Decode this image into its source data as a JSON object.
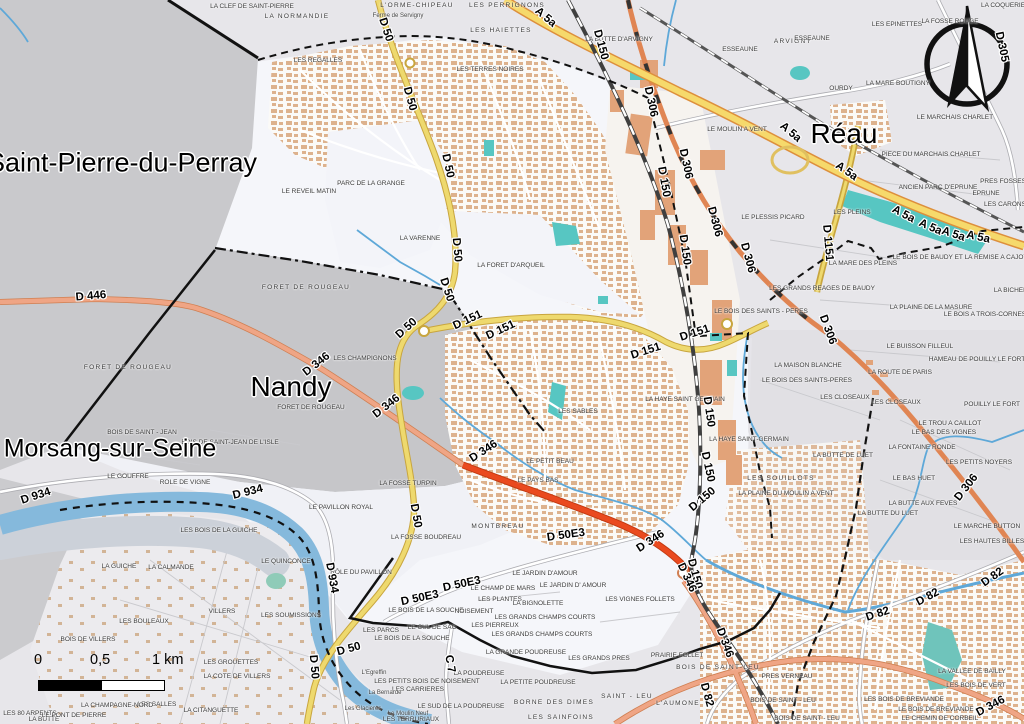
{
  "map": {
    "colors": {
      "water": "#85b9dc",
      "pond": "#57c6c2",
      "motorway": "#f6d96b",
      "motorway_casing": "#dd8f3c",
      "primary_orange": "#e08553",
      "secondary_salmon": "#efa585",
      "trunk_red": "#ea4a1f",
      "tertiary_yellow": "#eed96e",
      "forest_gray": "#c6c6c9",
      "neighbor_gray": "#c9c9cc",
      "commune_white": "#f5f6fa",
      "urban_building": "#ddb28d",
      "boundary": "#111111"
    },
    "towns": [
      {
        "t": "Saint-Pierre-du-Perray",
        "x": 122,
        "y": 163,
        "s": 27
      },
      {
        "t": "Morsang-sur-Seine",
        "x": 110,
        "y": 449,
        "s": 25
      },
      {
        "t": "Nandy",
        "x": 291,
        "y": 387,
        "s": 28
      },
      {
        "t": "Réau",
        "x": 844,
        "y": 134,
        "s": 28
      }
    ],
    "road_shields": [
      {
        "t": "D 50",
        "x": 385,
        "y": 30,
        "r": 72
      },
      {
        "t": "D 50",
        "x": 409,
        "y": 99,
        "r": 75
      },
      {
        "t": "D 50",
        "x": 447,
        "y": 166,
        "r": 78
      },
      {
        "t": "D 50",
        "x": 456,
        "y": 250,
        "r": 85
      },
      {
        "t": "D 50",
        "x": 446,
        "y": 290,
        "r": 72
      },
      {
        "t": "D 50",
        "x": 407,
        "y": 329,
        "r": -42
      },
      {
        "t": "D 50",
        "x": 415,
        "y": 516,
        "r": 80
      },
      {
        "t": "D 50",
        "x": 313,
        "y": 667,
        "r": 85
      },
      {
        "t": "D 50",
        "x": 349,
        "y": 650,
        "r": -15
      },
      {
        "t": "D 151",
        "x": 468,
        "y": 321,
        "r": -25
      },
      {
        "t": "D 151",
        "x": 501,
        "y": 331,
        "r": -25
      },
      {
        "t": "D 151",
        "x": 646,
        "y": 352,
        "r": -18
      },
      {
        "t": "D 151",
        "x": 695,
        "y": 334,
        "r": -18
      },
      {
        "t": "D 150",
        "x": 600,
        "y": 45,
        "r": 75
      },
      {
        "t": "D 150",
        "x": 663,
        "y": 182,
        "r": 80
      },
      {
        "t": "D 150",
        "x": 684,
        "y": 250,
        "r": 82
      },
      {
        "t": "D 150",
        "x": 708,
        "y": 412,
        "r": 82
      },
      {
        "t": "D 150",
        "x": 707,
        "y": 467,
        "r": 78
      },
      {
        "t": "D 150",
        "x": 703,
        "y": 500,
        "r": -40
      },
      {
        "t": "D 150",
        "x": 694,
        "y": 574,
        "r": 75
      },
      {
        "t": "D 306",
        "x": 650,
        "y": 102,
        "r": 78
      },
      {
        "t": "D 306",
        "x": 685,
        "y": 164,
        "r": 78
      },
      {
        "t": "D 306",
        "x": 714,
        "y": 222,
        "r": 75
      },
      {
        "t": "D 306",
        "x": 747,
        "y": 258,
        "r": 75
      },
      {
        "t": "D 306",
        "x": 827,
        "y": 330,
        "r": 70
      },
      {
        "t": "D 306",
        "x": 967,
        "y": 488,
        "r": -52
      },
      {
        "t": "A 5a",
        "x": 545,
        "y": 18,
        "r": 40
      },
      {
        "t": "A 5a",
        "x": 790,
        "y": 133,
        "r": 40
      },
      {
        "t": "A 5a",
        "x": 846,
        "y": 172,
        "r": 35
      },
      {
        "t": "A 5a",
        "x": 903,
        "y": 215,
        "r": 28
      },
      {
        "t": "A 5a",
        "x": 930,
        "y": 228,
        "r": 24
      },
      {
        "t": "A 5a",
        "x": 953,
        "y": 235,
        "r": 18
      },
      {
        "t": "A 5a",
        "x": 978,
        "y": 238,
        "r": 12
      },
      {
        "t": "D 446",
        "x": 91,
        "y": 297,
        "r": -5
      },
      {
        "t": "D 934",
        "x": 36,
        "y": 497,
        "r": -18
      },
      {
        "t": "D 934",
        "x": 248,
        "y": 493,
        "r": -14
      },
      {
        "t": "D 934",
        "x": 331,
        "y": 578,
        "r": 80
      },
      {
        "t": "D 82",
        "x": 993,
        "y": 578,
        "r": -35
      },
      {
        "t": "D 82",
        "x": 928,
        "y": 598,
        "r": -28
      },
      {
        "t": "D 82",
        "x": 878,
        "y": 615,
        "r": -18
      },
      {
        "t": "D 82",
        "x": 706,
        "y": 695,
        "r": 75
      },
      {
        "t": "D 346",
        "x": 317,
        "y": 365,
        "r": -38
      },
      {
        "t": "D 346",
        "x": 387,
        "y": 407,
        "r": -38
      },
      {
        "t": "D 346",
        "x": 484,
        "y": 452,
        "r": -33
      },
      {
        "t": "D 346",
        "x": 651,
        "y": 542,
        "r": -33
      },
      {
        "t": "D 346",
        "x": 686,
        "y": 578,
        "r": 65
      },
      {
        "t": "D 346",
        "x": 724,
        "y": 643,
        "r": 70
      },
      {
        "t": "D 346",
        "x": 991,
        "y": 707,
        "r": -28
      },
      {
        "t": "D 50E3",
        "x": 566,
        "y": 536,
        "r": -8
      },
      {
        "t": "D 50E3",
        "x": 462,
        "y": 585,
        "r": -12
      },
      {
        "t": "D 50E3",
        "x": 420,
        "y": 599,
        "r": -12
      },
      {
        "t": "C 7",
        "x": 449,
        "y": 664,
        "r": 80
      },
      {
        "t": "D 1151",
        "x": 827,
        "y": 243,
        "r": 85
      },
      {
        "t": "D 305",
        "x": 1001,
        "y": 47,
        "r": 78
      }
    ],
    "places": [
      {
        "t": "LA CLEF DE SAINT-PIERRE",
        "x": 252,
        "y": 7
      },
      {
        "t": "LA NORMANDIE",
        "x": 297,
        "y": 17,
        "sp": 1
      },
      {
        "t": "L'ORME-CHIPEAU",
        "x": 417,
        "y": 6,
        "sp": 1
      },
      {
        "t": "LES PERRIGNONS",
        "x": 507,
        "y": 6,
        "sp": 1
      },
      {
        "t": "Ferme de Servigny",
        "x": 398,
        "y": 16,
        "mc": 1
      },
      {
        "t": "LES HAIETTES",
        "x": 501,
        "y": 31,
        "sp": 1
      },
      {
        "t": "LES REGALLES",
        "x": 318,
        "y": 61
      },
      {
        "t": "LES TERRES NOIRES",
        "x": 490,
        "y": 70
      },
      {
        "t": "LA BUTTE D'ARVIGNY",
        "x": 619,
        "y": 40
      },
      {
        "t": "ARVIGNY",
        "x": 793,
        "y": 42,
        "sp": 1
      },
      {
        "t": "ESSEAUNE",
        "x": 812,
        "y": 39
      },
      {
        "t": "ESSEAUNE",
        "x": 740,
        "y": 50
      },
      {
        "t": "LES EPINETTES",
        "x": 897,
        "y": 25
      },
      {
        "t": "LA FOSSE ROUGE",
        "x": 950,
        "y": 22
      },
      {
        "t": "LA COQUERIE",
        "x": 1003,
        "y": 6
      },
      {
        "t": "OURDY",
        "x": 841,
        "y": 89
      },
      {
        "t": "LA MARE BOUTIGNY",
        "x": 898,
        "y": 84
      },
      {
        "t": "LE MARCHAIS CHARLET",
        "x": 955,
        "y": 118
      },
      {
        "t": "LE MOULIN A VENT",
        "x": 737,
        "y": 130
      },
      {
        "t": "PIECE DU MARCHAIS CHARLET",
        "x": 931,
        "y": 155
      },
      {
        "t": "ANCIEN PARC D'EPRUNE",
        "x": 938,
        "y": 188
      },
      {
        "t": "PRES FOSSES",
        "x": 1003,
        "y": 182
      },
      {
        "t": "EPRUNE",
        "x": 986,
        "y": 194
      },
      {
        "t": "LES CARONS",
        "x": 1005,
        "y": 205
      },
      {
        "t": "LES PLEINS",
        "x": 852,
        "y": 213
      },
      {
        "t": "LE PLESSIS PICARD",
        "x": 773,
        "y": 218
      },
      {
        "t": "LA MARE DES PLEINS",
        "x": 863,
        "y": 264
      },
      {
        "t": "LES GRANDS REAGES DE BAUDY",
        "x": 822,
        "y": 289
      },
      {
        "t": "LE BOIS DE BAUDY ET LA REMISE A CAJOT",
        "x": 960,
        "y": 258
      },
      {
        "t": "LA BICHERE",
        "x": 1013,
        "y": 291
      },
      {
        "t": "LA PLAINE DE LA MASURE",
        "x": 931,
        "y": 308
      },
      {
        "t": "LE BOIS A TROIS-CORNES",
        "x": 985,
        "y": 315
      },
      {
        "t": "LE BUISSON FILLEUL",
        "x": 920,
        "y": 347
      },
      {
        "t": "HAMEAU DE POUILLY LE FORT",
        "x": 977,
        "y": 360
      },
      {
        "t": "LA ROUTE DE PARIS",
        "x": 900,
        "y": 373
      },
      {
        "t": "POUILLY LE FORT",
        "x": 992,
        "y": 405
      },
      {
        "t": "LE TROU A CAILLOT",
        "x": 950,
        "y": 424
      },
      {
        "t": "LE BAS DES VIGNES",
        "x": 944,
        "y": 433
      },
      {
        "t": "LA FONTAINE RONDE",
        "x": 922,
        "y": 448
      },
      {
        "t": "LES PETITS NOYERS",
        "x": 979,
        "y": 463
      },
      {
        "t": "LE BAS HUET",
        "x": 914,
        "y": 479
      },
      {
        "t": "LA BUTTE AUX FEVES",
        "x": 923,
        "y": 504
      },
      {
        "t": "LE MARCHE BUTTON",
        "x": 987,
        "y": 527
      },
      {
        "t": "LES HAUTES BILLES",
        "x": 992,
        "y": 542
      },
      {
        "t": "LA BUTTE DE LUET",
        "x": 843,
        "y": 456
      },
      {
        "t": "LA BUTTE DU LUET",
        "x": 888,
        "y": 514
      },
      {
        "t": "LES SOUILLOTS",
        "x": 781,
        "y": 479,
        "sp": 1
      },
      {
        "t": "LA PLAINE DU MOULIN A VENT",
        "x": 786,
        "y": 494
      },
      {
        "t": "LA HAYE SAINT-GERMAIN",
        "x": 749,
        "y": 440
      },
      {
        "t": "LA HAYE SAINT GERMAIN",
        "x": 685,
        "y": 400
      },
      {
        "t": "LES SABLES",
        "x": 578,
        "y": 412
      },
      {
        "t": "LES CLOSEAUX",
        "x": 845,
        "y": 398
      },
      {
        "t": "LES CLOSEAUX",
        "x": 896,
        "y": 403
      },
      {
        "t": "LA MAISON BLANCHE",
        "x": 808,
        "y": 366
      },
      {
        "t": "LE BOIS DES SAINTS-PERES",
        "x": 807,
        "y": 381
      },
      {
        "t": "LE BOIS DES SAINTS - PERES",
        "x": 761,
        "y": 312
      },
      {
        "t": "PARC DE LA GRANGE",
        "x": 371,
        "y": 184
      },
      {
        "t": "LE REVEIL MATIN",
        "x": 309,
        "y": 192
      },
      {
        "t": "LA VARENNE",
        "x": 420,
        "y": 239
      },
      {
        "t": "LA FORET D'ARQUEIL",
        "x": 511,
        "y": 266
      },
      {
        "t": "FORET DE ROUGEAU",
        "x": 306,
        "y": 288,
        "sp": 1
      },
      {
        "t": "FORET DE ROUGEAU",
        "x": 128,
        "y": 368,
        "sp": 1
      },
      {
        "t": "FORET DE ROUGEAU",
        "x": 311,
        "y": 408
      },
      {
        "t": "LES CHAMPIGNONS",
        "x": 365,
        "y": 359
      },
      {
        "t": "BOIS DE SAINT - JEAN",
        "x": 142,
        "y": 433
      },
      {
        "t": "BOIS DE SAINT-JEAN DE L'ISLE",
        "x": 230,
        "y": 443
      },
      {
        "t": "LE GOUFFRE",
        "x": 128,
        "y": 477
      },
      {
        "t": "ROLE DE VIGNE",
        "x": 185,
        "y": 483
      },
      {
        "t": "LE PAVILLON ROYAL",
        "x": 341,
        "y": 508
      },
      {
        "t": "LES BOIS DE LA GUICHE",
        "x": 219,
        "y": 531
      },
      {
        "t": "LE QUINCONCE",
        "x": 286,
        "y": 562
      },
      {
        "t": "LA GUICHE",
        "x": 119,
        "y": 567
      },
      {
        "t": "LA CALMANDE",
        "x": 171,
        "y": 568
      },
      {
        "t": "VILLERS",
        "x": 222,
        "y": 612
      },
      {
        "t": "LES BOULEAUX",
        "x": 144,
        "y": 622
      },
      {
        "t": "BOIS DE VILLERS",
        "x": 88,
        "y": 640
      },
      {
        "t": "LES SOUMISSIONS",
        "x": 291,
        "y": 616
      },
      {
        "t": "LES GROUETTES",
        "x": 231,
        "y": 663
      },
      {
        "t": "LA COTE DE VILLERS",
        "x": 237,
        "y": 677
      },
      {
        "t": "LES SALLES",
        "x": 157,
        "y": 705
      },
      {
        "t": "LA CHAMPAGNE-NORD",
        "x": 117,
        "y": 706
      },
      {
        "t": "LES 80 ARPENTS",
        "x": 30,
        "y": 714
      },
      {
        "t": "LA BUTTE",
        "x": 44,
        "y": 720
      },
      {
        "t": "LE PONT DE PIERRE",
        "x": 74,
        "y": 716
      },
      {
        "t": "LA CITANGUETTE",
        "x": 211,
        "y": 711
      },
      {
        "t": "LA FOSSE TURPIN",
        "x": 408,
        "y": 484
      },
      {
        "t": "LA FOSSE BOUDREAU",
        "x": 426,
        "y": 538
      },
      {
        "t": "MONTBREAU",
        "x": 498,
        "y": 527,
        "sp": 1
      },
      {
        "t": "LE PETIT BEAU",
        "x": 550,
        "y": 462
      },
      {
        "t": "LE PAYS BAS",
        "x": 538,
        "y": 481
      },
      {
        "t": "RÔLE DU PAVILLON",
        "x": 361,
        "y": 573
      },
      {
        "t": "LES PARCS",
        "x": 381,
        "y": 631
      },
      {
        "t": "LE BOIS DE LA SOUCHE",
        "x": 426,
        "y": 611
      },
      {
        "t": "NOISEMENT",
        "x": 474,
        "y": 612
      },
      {
        "t": "LE CUL DE SAC",
        "x": 432,
        "y": 628
      },
      {
        "t": "LE BOIS DE LA SOUCHE",
        "x": 412,
        "y": 639
      },
      {
        "t": "LES PIERREUX",
        "x": 495,
        "y": 626
      },
      {
        "t": "LE CHAMP DE MARS",
        "x": 503,
        "y": 589
      },
      {
        "t": "LES PLANTES",
        "x": 500,
        "y": 600
      },
      {
        "t": "LA BIGNOLETTE",
        "x": 538,
        "y": 604
      },
      {
        "t": "LE JARDIN D'AMOUR",
        "x": 545,
        "y": 574
      },
      {
        "t": "LE JARDIN D' AMOUR",
        "x": 573,
        "y": 586
      },
      {
        "t": "LES GRANDS CHAMPS COURTS",
        "x": 545,
        "y": 618
      },
      {
        "t": "LES GRANDS CHAMPS COURTS",
        "x": 542,
        "y": 635
      },
      {
        "t": "LES VIGNES FOLLETS",
        "x": 640,
        "y": 600
      },
      {
        "t": "LA GRANDE POUDREUSE",
        "x": 526,
        "y": 653
      },
      {
        "t": "LES GRANDS PRES",
        "x": 599,
        "y": 659
      },
      {
        "t": "PRAIRIE FOLLET",
        "x": 677,
        "y": 656
      },
      {
        "t": "BOIS DE SAINT-LEU",
        "x": 718,
        "y": 668,
        "sp": 1
      },
      {
        "t": "LA POUDREUSE",
        "x": 479,
        "y": 674
      },
      {
        "t": "LES PETITS BOIS DE NOISEMENT",
        "x": 427,
        "y": 682
      },
      {
        "t": "LES CARRIERES",
        "x": 418,
        "y": 690
      },
      {
        "t": "La Bernarde",
        "x": 385,
        "y": 693,
        "mc": 1
      },
      {
        "t": "L'Egreffin",
        "x": 374,
        "y": 673,
        "mc": 1
      },
      {
        "t": "Les Glacieres",
        "x": 363,
        "y": 709,
        "mc": 1
      },
      {
        "t": "Le Moulin Neuf",
        "x": 408,
        "y": 714,
        "mc": 1
      },
      {
        "t": "LES TERRURIAUX",
        "x": 411,
        "y": 720
      },
      {
        "t": "LE SUD DE LA POUDREUSE",
        "x": 461,
        "y": 707
      },
      {
        "t": "LA PETITE POUDREUSE",
        "x": 538,
        "y": 683
      },
      {
        "t": "BORNE DES DIMES",
        "x": 554,
        "y": 703,
        "sp": 1
      },
      {
        "t": "LES SAINFOINS",
        "x": 561,
        "y": 718,
        "sp": 1
      },
      {
        "t": "SAINT - LEU",
        "x": 627,
        "y": 697,
        "sp": 1
      },
      {
        "t": "L'AUMONE",
        "x": 678,
        "y": 704,
        "sp": 1
      },
      {
        "t": "PRES VERNEAU",
        "x": 787,
        "y": 677
      },
      {
        "t": "BOIS DE SAINT - LEU",
        "x": 783,
        "y": 701
      },
      {
        "t": "BOIS DE SAINT - LEU",
        "x": 807,
        "y": 719
      },
      {
        "t": "LA VALLEE DE BAILLY",
        "x": 972,
        "y": 672
      },
      {
        "t": "LES BOIS DE VERT",
        "x": 976,
        "y": 686
      },
      {
        "t": "LES BOIS DE BREVIANDE",
        "x": 904,
        "y": 700
      },
      {
        "t": "LE BOIS DE BREVIANDE",
        "x": 936,
        "y": 710
      },
      {
        "t": "LE CHEMIN DE CORBEIL",
        "x": 940,
        "y": 719
      }
    ],
    "scale_bar": {
      "ticks": {
        "zero": "0",
        "half": "0,5",
        "one": "1 km"
      }
    }
  }
}
